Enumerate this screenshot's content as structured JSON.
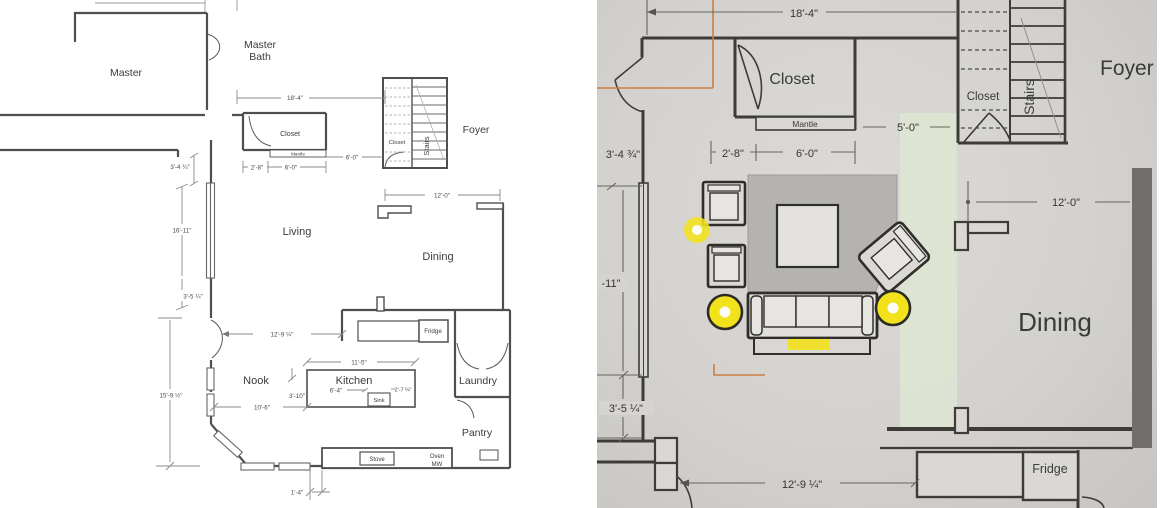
{
  "left": {
    "rooms": {
      "master": "Master",
      "master_bath_line1": "Master",
      "master_bath_line2": "Bath",
      "closet": "Closet",
      "stairs_closet": "Closet",
      "stairs": "Stairs",
      "foyer": "Foyer",
      "living": "Living",
      "dining": "Dining",
      "nook": "Nook",
      "kitchen": "Kitchen",
      "laundry": "Laundry",
      "pantry": "Pantry"
    },
    "fixtures": {
      "mantle": "Mantle",
      "fridge": "Fridge",
      "sink": "Sink",
      "stove": "Stove",
      "oven": "Oven",
      "mw": "MW"
    },
    "dims": {
      "w18_4": "18'-4\"",
      "h3_4": "3'-4 ¼\"",
      "w2_8": "2'-8\"",
      "w6_0": "6'-0\"",
      "w6_0b": "6'-0\"",
      "h16_11": "16'-11\"",
      "h3_5": "3'-5 ¼\"",
      "w12_0": "12'-0\"",
      "w12_9": "12'-9 ¼\"",
      "w11_5": "11'-5\"",
      "h15_9": "15'-9 ½\"",
      "w10_6": "10'-6\"",
      "h3_10": "3'-10\"",
      "w6_4": "6'-4\"",
      "w2_7": "2'-7 ¼\"",
      "w1_4": "1'-4\""
    }
  },
  "right": {
    "rooms": {
      "closet": "Closet",
      "stairs_closet": "Closet",
      "stairs": "Stairs",
      "foyer": "Foyer",
      "dining": "Dining"
    },
    "fixtures": {
      "mantle": "Mantle",
      "fridge": "Fridge"
    },
    "dims": {
      "w18_4": "18'-4\"",
      "w5_0": "5'-0\"",
      "h3_4": "3'-4 ¾\"",
      "w2_8": "2'-8\"",
      "w6_0": "6'-0\"",
      "w12_0": "12'-0\"",
      "h16_11": "-11\"",
      "h3_5": "3'-5 ¼\"",
      "w12_9": "12'-9 ¼\""
    }
  },
  "colors": {
    "highlight_yellow": "#f2e21c",
    "selection_orange": "#c98044",
    "green_tint": "#dfe7d2",
    "plan_wall": "#4f4f4f",
    "photo_wall": "#3d3c38",
    "dark_bar": "#6f6e6b",
    "rug_gray": "#b4b3b1"
  }
}
